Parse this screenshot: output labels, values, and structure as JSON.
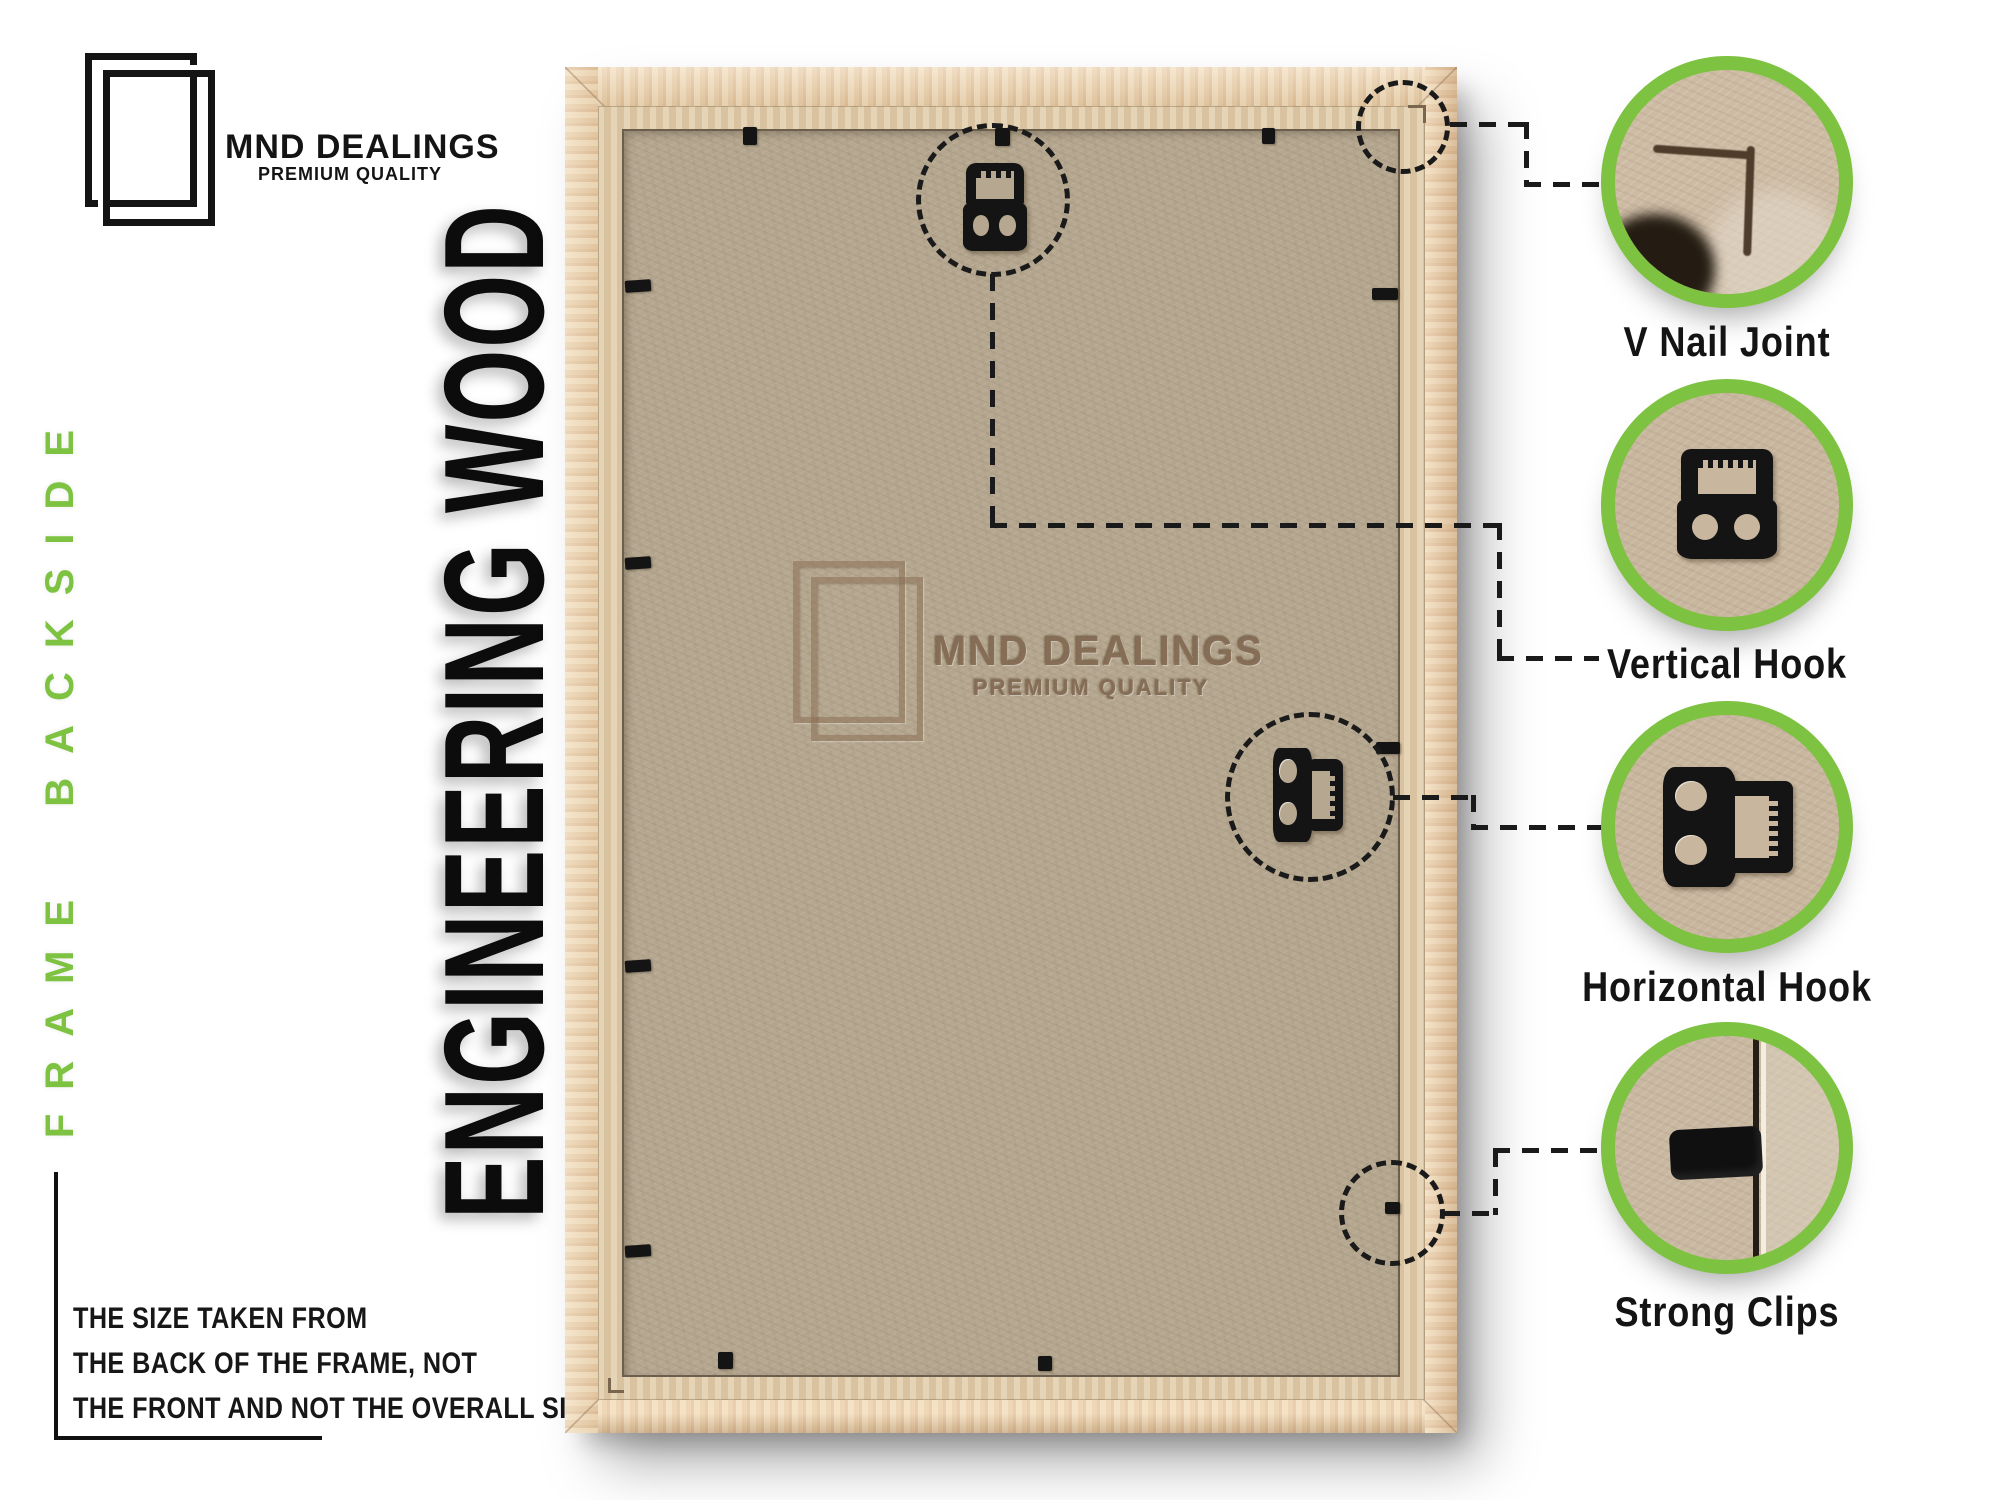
{
  "brand": {
    "name": "MND DEALINGS",
    "tagline": "PREMIUM QUALITY"
  },
  "side_label": "FRAME BACKSIDE",
  "material_label": "ENGINEERING WOOD",
  "size_note": {
    "lines": [
      "THE SIZE TAKEN FROM",
      "THE BACK OF THE FRAME, NOT",
      "THE FRONT AND NOT THE OVERALL SIZE."
    ]
  },
  "watermark": {
    "name": "MND DEALINGS",
    "tagline": "PREMIUM QUALITY"
  },
  "callouts": [
    {
      "label": "V Nail Joint",
      "icon": "v-nail-joint-photo"
    },
    {
      "label": "Vertical Hook",
      "icon": "vertical-hook-photo"
    },
    {
      "label": "Horizontal Hook",
      "icon": "horizontal-hook-photo"
    },
    {
      "label": "Strong Clips",
      "icon": "strong-clip-photo"
    }
  ],
  "colors": {
    "accent_green": "#7dc241",
    "ink_black": "#141414",
    "wood": "#ecd2aa",
    "lip": "#dcc7a4",
    "board": "#b6a890",
    "cardboard": "#c8b69e"
  }
}
